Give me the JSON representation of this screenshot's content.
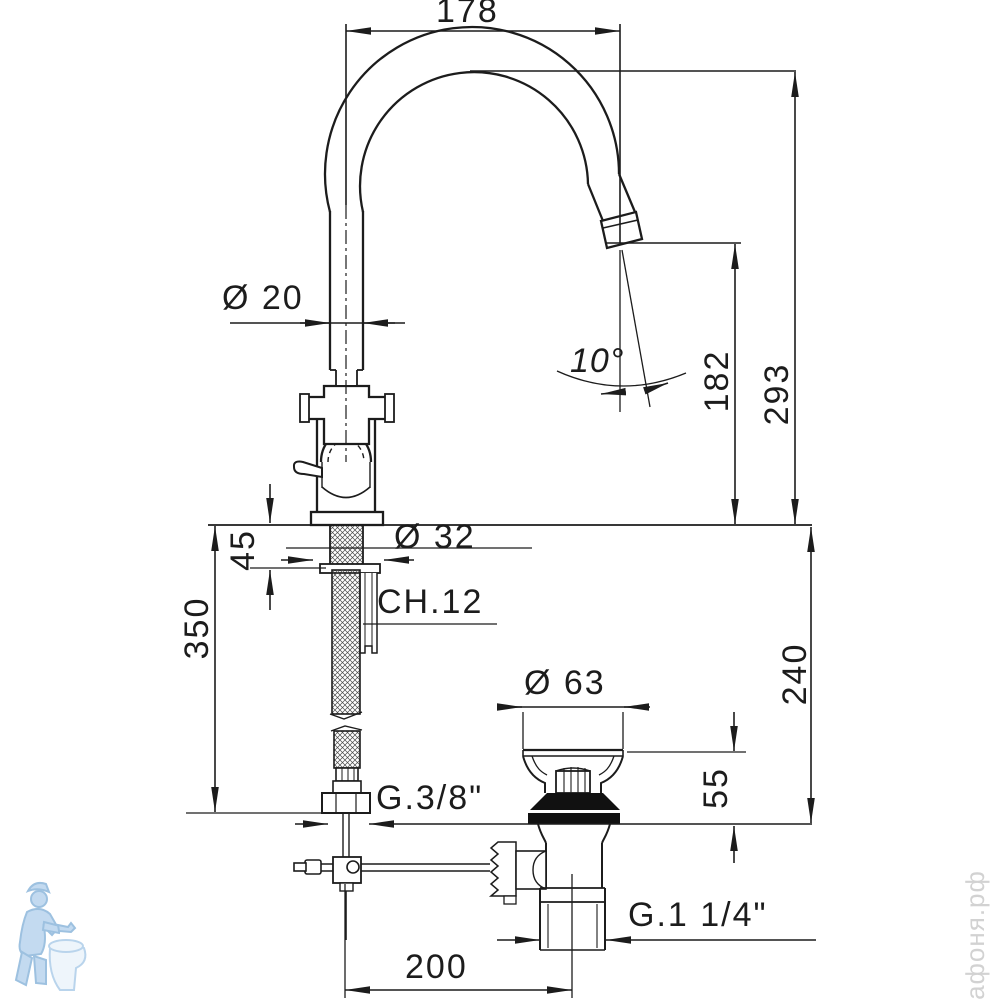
{
  "drawing": {
    "dimensions": {
      "spout_reach": "178",
      "spout_diameter": "Ø 20",
      "outlet_angle": "10°",
      "outlet_height": "182",
      "total_height": "293",
      "base_diameter": "Ø 32",
      "deck_thickness": "45",
      "wrench_size": "CH.12",
      "hose_length": "350",
      "waste_flange_diameter": "Ø 63",
      "waste_height": "55",
      "under_deck_height": "240",
      "supply_thread": "G.3/8\"",
      "waste_thread": "G.1 1/4\"",
      "drain_offset": "200"
    },
    "watermark_text": "афоня.рф",
    "colors": {
      "line": "#1c1c1c",
      "background": "#ffffff",
      "watermark_blue": "#bdd7ee",
      "watermark_gray": "#d2d2d2"
    }
  }
}
